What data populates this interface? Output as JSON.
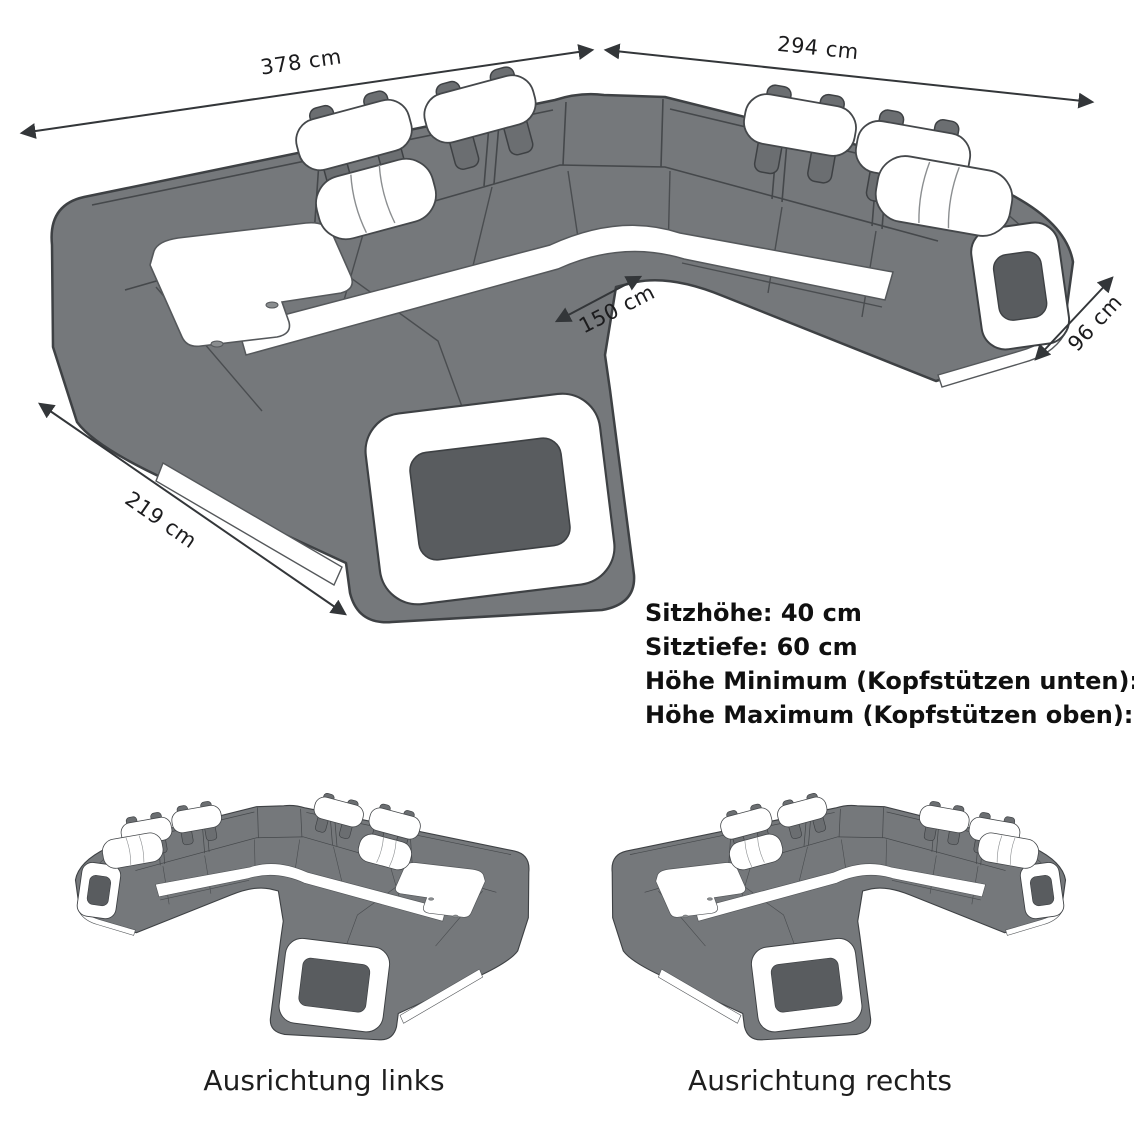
{
  "diagram": {
    "title": "sofa-dimension-diagram",
    "dimensions": [
      {
        "id": "width-left",
        "label": "378 cm"
      },
      {
        "id": "width-right",
        "label": "294 cm"
      },
      {
        "id": "depth-left",
        "label": "219 cm"
      },
      {
        "id": "chaise-width",
        "label": "150 cm"
      },
      {
        "id": "depth-right",
        "label": "96 cm"
      }
    ],
    "specs": {
      "line1": "Sitzhöhe: 40 cm",
      "line2": "Sitztiefe: 60 cm",
      "line3": "Höhe Minimum (Kopfstützen unten): 80 cm",
      "line4": "Höhe Maximum (Kopfstützen oben): 98 cm"
    },
    "variants": [
      {
        "id": "links",
        "label": "Ausrichtung links"
      },
      {
        "id": "rechts",
        "label": "Ausrichtung rechts"
      }
    ],
    "colors": {
      "sofa_gray": "#75787b",
      "sofa_shade": "#6b6e71",
      "outline": "#3e4144",
      "accent_white": "#ffffff",
      "hole_dark": "#595c5f",
      "dimension_line": "#333639"
    }
  }
}
